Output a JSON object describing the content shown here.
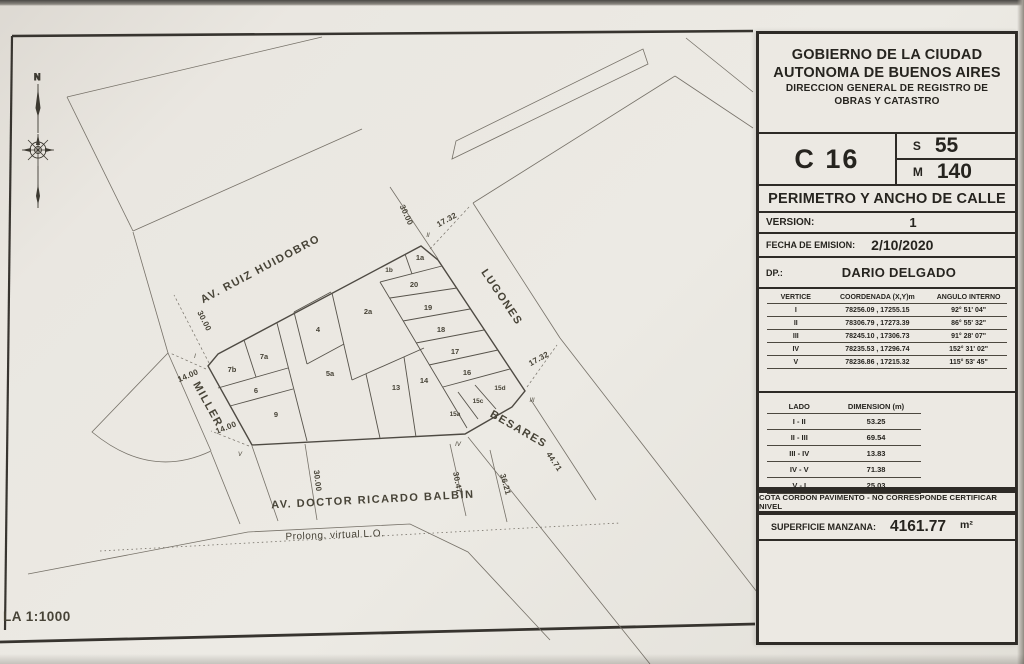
{
  "page": {
    "scale_label": "LA 1:1000",
    "compass": "N"
  },
  "title_block": {
    "org": [
      "GOBIERNO DE LA CIUDAD",
      "AUTONOMA DE BUENOS AIRES",
      "DIRECCION GENERAL DE REGISTRO DE",
      "OBRAS Y CATASTRO"
    ],
    "circunscripcion": {
      "label": "C",
      "value": "16"
    },
    "seccion": {
      "label": "S",
      "value": "55"
    },
    "manzana": {
      "label": "M",
      "value": "140"
    },
    "doc_title": "PERIMETRO Y ANCHO DE CALLE",
    "version": {
      "label": "VERSION:",
      "value": "1"
    },
    "fecha": {
      "label": "FECHA DE EMISION:",
      "value": "2/10/2020"
    },
    "dp": {
      "label": "DP.:",
      "value": "DARIO DELGADO"
    },
    "vertices_table": {
      "headers": [
        "VERTICE",
        "COORDENADA (X,Y)m",
        "ANGULO INTERNO"
      ],
      "rows": [
        {
          "vertice": "I",
          "coordenada": "78256.09 , 17255.15",
          "angulo": "92° 51' 04\""
        },
        {
          "vertice": "II",
          "coordenada": "78306.79 , 17273.39",
          "angulo": "86° 55' 32\""
        },
        {
          "vertice": "III",
          "coordenada": "78245.10 , 17306.73",
          "angulo": "91° 28' 07\""
        },
        {
          "vertice": "IV",
          "coordenada": "78235.53 , 17296.74",
          "angulo": "152° 31' 02\""
        },
        {
          "vertice": "V",
          "coordenada": "78236.86 , 17215.32",
          "angulo": "115° 53' 45\""
        }
      ]
    },
    "lados_table": {
      "headers": [
        "LADO",
        "DIMENSION (m)"
      ],
      "rows": [
        {
          "lado": "I - II",
          "dimension": "53.25"
        },
        {
          "lado": "II - III",
          "dimension": "69.54"
        },
        {
          "lado": "III - IV",
          "dimension": "13.83"
        },
        {
          "lado": "IV - V",
          "dimension": "71.38"
        },
        {
          "lado": "V - I",
          "dimension": "25.03"
        }
      ]
    },
    "cota_note": "COTA CORDON PAVIMENTO - NO CORRESPONDE CERTIFICAR NIVEL",
    "superficie": {
      "label": "SUPERFICIE MANZANA:",
      "value": "4161.77",
      "unit": "m²"
    }
  },
  "map": {
    "streets": {
      "ruiz_huidobro": "AV. RUIZ HUIDOBRO",
      "lugones": "LUGONES",
      "miller": "MILLER",
      "besares": "BESARES",
      "balbin": "AV. DOCTOR RICARDO BALBIN",
      "prolong": "Prolong. virtual L.O."
    },
    "lots": [
      "1a",
      "1b",
      "20",
      "19",
      "18",
      "2a",
      "4",
      "17",
      "7a",
      "7b",
      "5a",
      "13",
      "14",
      "16",
      "6",
      "9",
      "15a",
      "15c",
      "15d"
    ],
    "dims": {
      "ruiz_top": "30.00",
      "lugones_top": "17.32",
      "ruiz_left": "30.00",
      "miller_a": "14.00",
      "miller_b": "14.00",
      "lugones_right": "17.32",
      "besares": "44.71",
      "d36": "36.21",
      "d30": "30.47",
      "balbin": "30.00"
    },
    "vertices": [
      "I",
      "II",
      "III",
      "IV",
      "V"
    ]
  }
}
